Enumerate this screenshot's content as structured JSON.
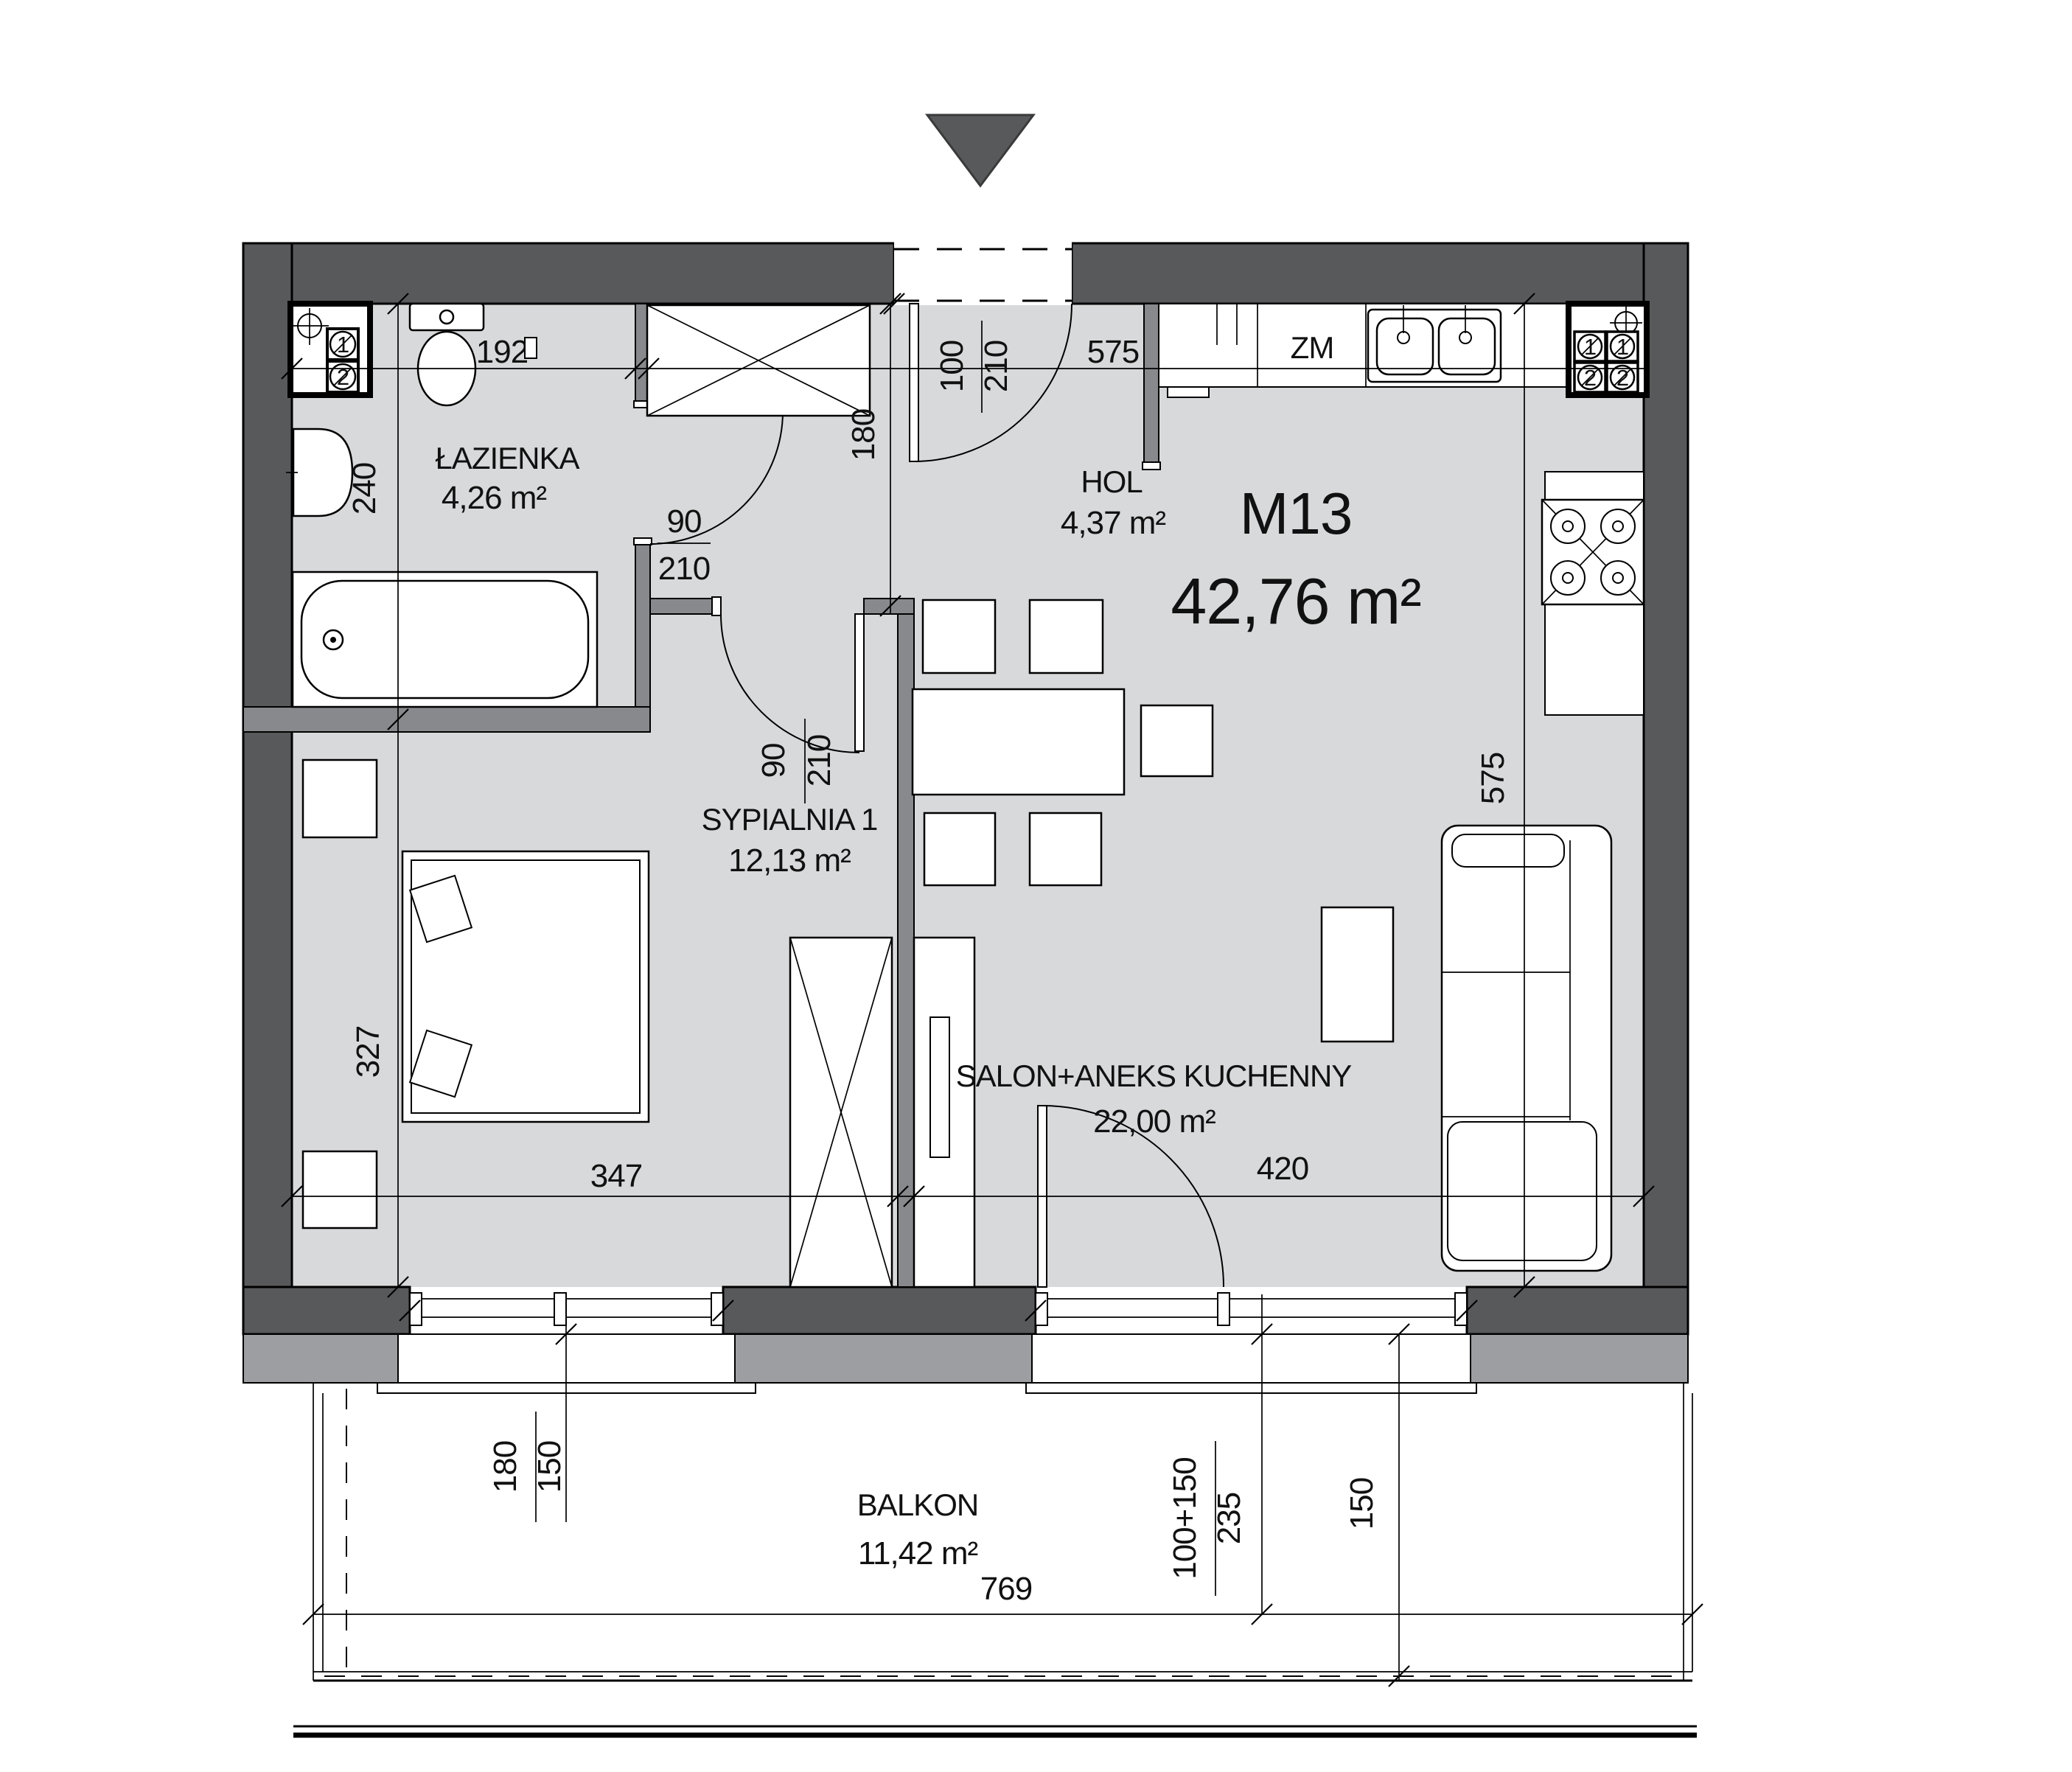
{
  "title_block": {
    "unit": "M13",
    "area": "42,76 m²"
  },
  "rooms": [
    {
      "name": "ŁAZIENKA",
      "area": "4,26 m²"
    },
    {
      "name": "HOL",
      "area": "4,37 m²"
    },
    {
      "name": "SYPIALNIA 1",
      "area": "12,13 m²"
    },
    {
      "name": "SALON+ANEKS KUCHENNY",
      "area": "22,00 m²"
    },
    {
      "name": "BALKON",
      "area": "11,42 m²"
    }
  ],
  "fixtures": {
    "dishwasher": "ZM",
    "flue1": "1",
    "flue2": "2"
  },
  "dimensions": {
    "bathroom_width": "192",
    "bathroom_depth": "240",
    "hall_depth": "180",
    "kitchen_run": "575",
    "living_depth": "575",
    "bedroom_depth": "327",
    "bedroom_width": "347",
    "living_width": "420",
    "balcony_width": "769",
    "balcony_depth": "150",
    "door_entry_w": "100",
    "door_entry_h": "210",
    "door_bath_w": "90",
    "door_bath_h": "210",
    "door_bedroom_w": "90",
    "door_bedroom_h": "210",
    "window_bedroom_w": "180",
    "window_bedroom_h": "150",
    "balcony_door_w": "100+150",
    "balcony_door_h": "235"
  },
  "colors": {
    "wall": "#58595b",
    "partition": "#87898c",
    "floor": "#d8d9da",
    "band": "#9c9ea1"
  }
}
